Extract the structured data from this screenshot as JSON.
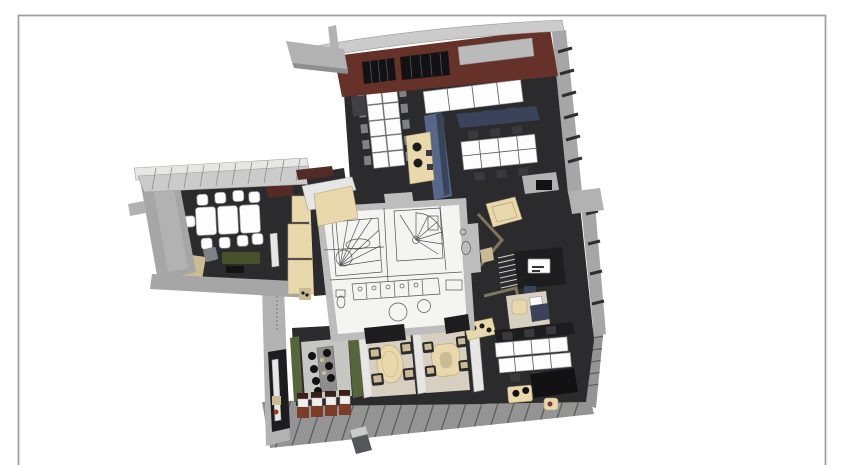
{
  "scene": {
    "title": "3D office floor plan render",
    "description": "Axonometric cutaway render of a single office level on a white slide with a thin gray frame border. No legible text labels are rendered.",
    "page_bg": "#ffffff",
    "frame_color": "#9e9e9e"
  },
  "colors": {
    "floor_dark": "#2b2b2d",
    "floor_darker": "#1d1d1f",
    "roof_maroon": "#653129",
    "panel_darkred": "#542a26",
    "canopy_light": "#cbcbcb",
    "canopy_mid": "#b2b2b2",
    "wall_gray": "#a6a6a6",
    "wall_light": "#e6e6e4",
    "core_wall": "#bdbdbd",
    "core_floor": "#f4f4f1",
    "line_gray": "#55565a",
    "desk_white": "#fdfdfd",
    "beige": "#e8d8ac",
    "beige_dark": "#cbbb92",
    "beige_floor": "#d7d0c1",
    "blue_panel": "#56688a",
    "blue_dark": "#39435a",
    "skylight_gray": "#bababa",
    "green_wall": "#55663b",
    "olive_sofa": "#49502c",
    "rust_chair": "#7b3c28",
    "black_furniture": "#121214",
    "bar_floor": "#c6c6c3",
    "bar_counter": "#8e8e8c",
    "walkway": "#949494",
    "walkway_edge": "#5e5e5e",
    "chair_gray": "#7e8286",
    "frame_color": "#9e9e9e",
    "page_bg": "#ffffff"
  },
  "zones": [
    {
      "id": "north-office-block",
      "label": "Open-plan office block (north) with white desk banks and maroon roof band"
    },
    {
      "id": "west-meeting-wing",
      "label": "Conference room wing (west) with white table, chairs and lounge sofa"
    },
    {
      "id": "central-core",
      "label": "Central service core: stairs, spiral stair, WC, kitchen in CAD linework"
    },
    {
      "id": "east-wing",
      "label": "East wing workstations, reception desk and alcove"
    },
    {
      "id": "south-wing",
      "label": "South wing: bar counter with stools, rust chairs, two meeting booths, desk row"
    },
    {
      "id": "entry-walkway",
      "label": "Hatched entry deck / walkway (south edge)"
    }
  ]
}
